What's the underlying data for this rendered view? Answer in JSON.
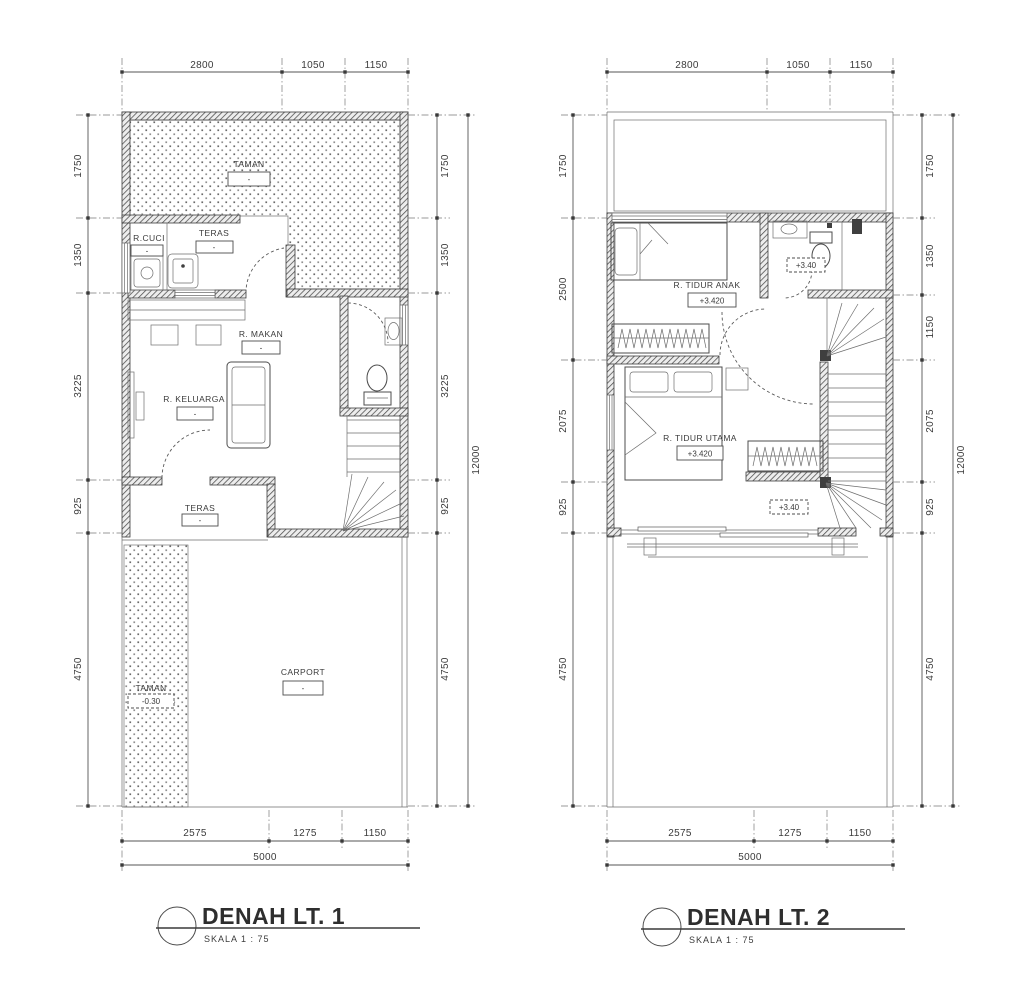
{
  "plan1": {
    "title": "DENAH LT. 1",
    "scale": "SKALA 1 : 75",
    "dims": {
      "top": [
        "2800",
        "1050",
        "1150"
      ],
      "left": [
        "1750",
        "1350",
        "3225",
        "925",
        "4750"
      ],
      "right": [
        "1750",
        "1350",
        "3225",
        "925",
        "4750"
      ],
      "total_height": "12000",
      "bottom": [
        "2575",
        "1275",
        "1150"
      ],
      "total_width": "5000"
    },
    "labels": {
      "taman": {
        "name": "TAMAN",
        "value": "-"
      },
      "rcuci": {
        "name": "R.CUCI",
        "value": "-"
      },
      "teras": {
        "name": "TERAS",
        "value": "-"
      },
      "rmakan": {
        "name": "R. MAKAN",
        "value": "-"
      },
      "rkeluarga": {
        "name": "R. KELUARGA",
        "value": "-"
      },
      "teras2": {
        "name": "TERAS",
        "value": "-"
      },
      "taman2": {
        "name": "TAMAN",
        "value": "-0.30"
      },
      "carport": {
        "name": "CARPORT",
        "value": "-"
      }
    }
  },
  "plan2": {
    "title": "DENAH LT. 2",
    "scale": "SKALA 1 : 75",
    "dims": {
      "top": [
        "2800",
        "1050",
        "1150"
      ],
      "left": [
        "1750",
        "2500",
        "2075",
        "925",
        "4750"
      ],
      "right": [
        "1750",
        "1350",
        "1150",
        "2075",
        "925",
        "4750"
      ],
      "total_height": "12000",
      "bottom": [
        "2575",
        "1275",
        "1150"
      ],
      "total_width": "5000"
    },
    "labels": {
      "tiduranak": {
        "name": "R. TIDUR ANAK",
        "value": "+3.420"
      },
      "bath": {
        "value": "+3.40"
      },
      "tidurutama": {
        "name": "R. TIDUR UTAMA",
        "value": "+3.420"
      },
      "stair": {
        "value": "+3.40"
      }
    }
  }
}
